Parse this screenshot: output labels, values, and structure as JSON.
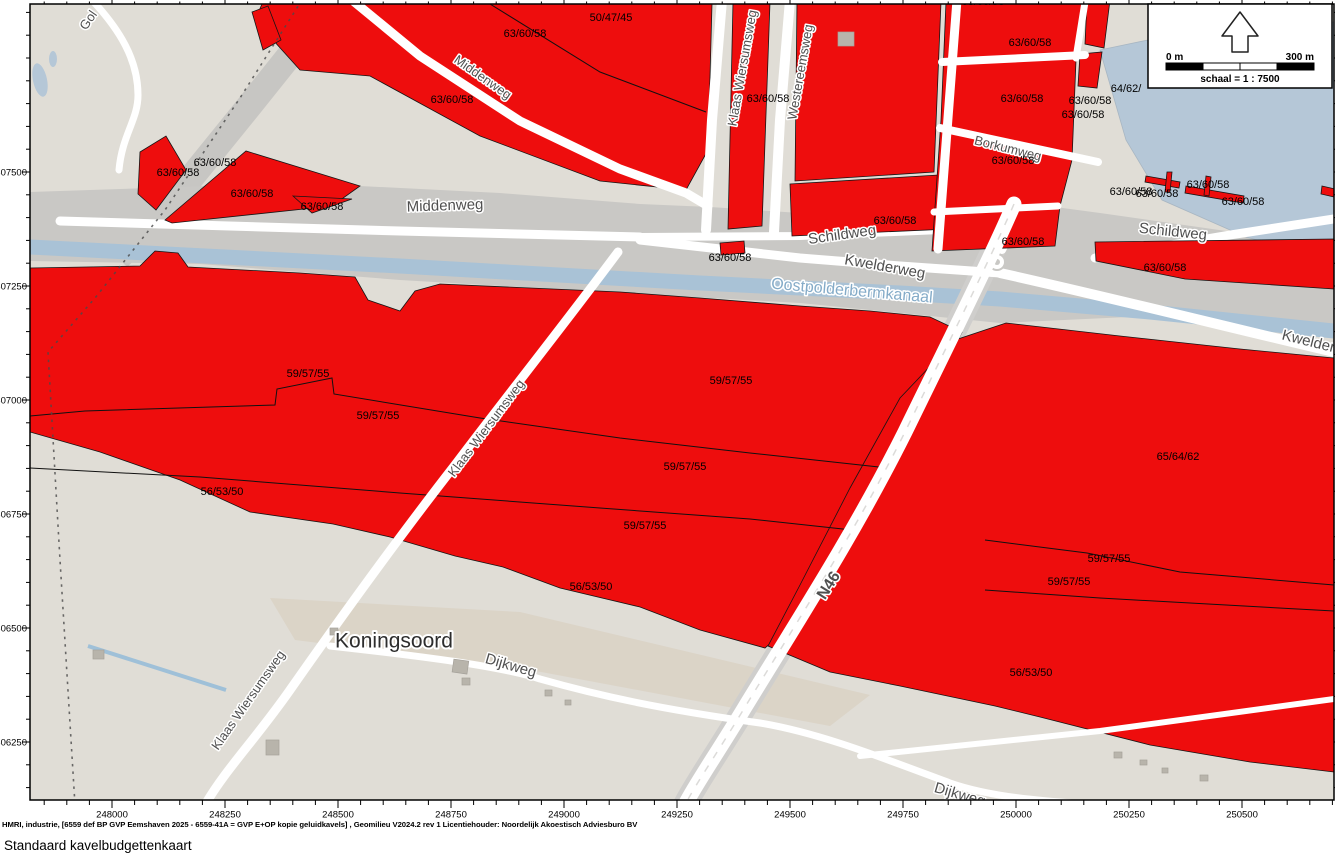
{
  "title": "Standaard kavelbudgettenkaart",
  "credit": "HMRI, industrie, [6559 def BP GVP Eemshaven 2025 - 6559-41A = GVP E+OP kopie geluidkavels] , Geomilieu V2024.2 rev 1 Licentiehouder: Noordelijk Akoestisch Adviesburo BV",
  "scale_box": {
    "left": "0 m",
    "right": "300 m",
    "text": "schaal = 1 : 7500"
  },
  "colors": {
    "zone_red": "#ee0d0d",
    "water": "#b5c7d7",
    "canal": "#a9c2d6",
    "corridor_gray": "#c9c8c5",
    "base_beige": "#e0ddd6",
    "road_white": "#ffffff",
    "road_label": "#4f4f4f",
    "water_label": "#84abc8",
    "green": "#ccd8a6",
    "building": "#b8b4ab"
  },
  "axes": {
    "x": [
      {
        "label": "248000",
        "pos": 112
      },
      {
        "label": "248250",
        "pos": 225
      },
      {
        "label": "248500",
        "pos": 338
      },
      {
        "label": "248750",
        "pos": 451
      },
      {
        "label": "249000",
        "pos": 564
      },
      {
        "label": "249250",
        "pos": 677
      },
      {
        "label": "249500",
        "pos": 790
      },
      {
        "label": "249750",
        "pos": 903
      },
      {
        "label": "250000",
        "pos": 1016
      },
      {
        "label": "250250",
        "pos": 1129
      },
      {
        "label": "250500",
        "pos": 1242
      }
    ],
    "y": [
      {
        "label": "607500",
        "pos": 172
      },
      {
        "label": "607250",
        "pos": 286
      },
      {
        "label": "607000",
        "pos": 400
      },
      {
        "label": "606750",
        "pos": 514
      },
      {
        "label": "606500",
        "pos": 628
      },
      {
        "label": "606250",
        "pos": 742
      }
    ]
  },
  "labels": {
    "values": [
      {
        "t": "50/47/45",
        "x": 611,
        "y": 17
      },
      {
        "t": "63/60/58",
        "x": 525,
        "y": 33
      },
      {
        "t": "63/60/58",
        "x": 452,
        "y": 99
      },
      {
        "t": "63/60/58",
        "x": 768,
        "y": 98
      },
      {
        "t": "63/60/58",
        "x": 983,
        "y": 1
      },
      {
        "t": "63/60/58",
        "x": 1030,
        "y": 42
      },
      {
        "t": "63/60/58",
        "x": 1022,
        "y": 98
      },
      {
        "t": "63/60/58",
        "x": 1090,
        "y": 100
      },
      {
        "t": "63/60/58",
        "x": 1083,
        "y": 114
      },
      {
        "t": "64/62/",
        "x": 1126,
        "y": 88
      },
      {
        "t": "63/60/58",
        "x": 1013,
        "y": 160
      },
      {
        "t": "63/60/58",
        "x": 215,
        "y": 162
      },
      {
        "t": "63/60/58",
        "x": 178,
        "y": 172
      },
      {
        "t": "63/60/58",
        "x": 252,
        "y": 193
      },
      {
        "t": "63/60/58",
        "x": 322,
        "y": 206
      },
      {
        "t": "63/60/58",
        "x": 895,
        "y": 220
      },
      {
        "t": "63/60/58",
        "x": 730,
        "y": 257
      },
      {
        "t": "63/60/58",
        "x": 1023,
        "y": 241
      },
      {
        "t": "63/60/58",
        "x": 1165,
        "y": 267
      },
      {
        "t": "63/60/58",
        "x": 1131,
        "y": 191
      },
      {
        "t": "63/60/58",
        "x": 1157,
        "y": 193
      },
      {
        "t": "63/60/58",
        "x": 1208,
        "y": 184
      },
      {
        "t": "63/60/58",
        "x": 1243,
        "y": 201
      },
      {
        "t": "59/57/55",
        "x": 308,
        "y": 373
      },
      {
        "t": "59/57/55",
        "x": 378,
        "y": 415
      },
      {
        "t": "59/57/55",
        "x": 731,
        "y": 380
      },
      {
        "t": "59/57/55",
        "x": 685,
        "y": 466
      },
      {
        "t": "59/57/55",
        "x": 645,
        "y": 525
      },
      {
        "t": "56/53/50",
        "x": 222,
        "y": 491
      },
      {
        "t": "56/53/50",
        "x": 591,
        "y": 586
      },
      {
        "t": "65/64/62",
        "x": 1178,
        "y": 456
      },
      {
        "t": "59/57/55",
        "x": 1109,
        "y": 558
      },
      {
        "t": "59/57/55",
        "x": 1069,
        "y": 581
      },
      {
        "t": "56/53/50",
        "x": 1031,
        "y": 672
      }
    ],
    "roads": [
      {
        "t": "Gol",
        "x": 88,
        "y": 20,
        "r": -55,
        "s": 13
      },
      {
        "t": "Middenweg",
        "x": 483,
        "y": 77,
        "r": 35,
        "s": 13
      },
      {
        "t": "Middenweg",
        "x": 445,
        "y": 205,
        "r": -2,
        "s": 15
      },
      {
        "t": "Klaas Wiersumsweg",
        "x": 742,
        "y": 68,
        "r": -80,
        "s": 13
      },
      {
        "t": "Westereemsweg",
        "x": 800,
        "y": 72,
        "r": -80,
        "s": 13
      },
      {
        "t": "Borkumweg",
        "x": 1008,
        "y": 148,
        "r": 14,
        "s": 13
      },
      {
        "t": "Schildweg",
        "x": 842,
        "y": 234,
        "r": -8,
        "s": 15
      },
      {
        "t": "Schildweg",
        "x": 1173,
        "y": 231,
        "r": 6,
        "s": 15
      },
      {
        "t": "Kwelderweg",
        "x": 885,
        "y": 266,
        "r": 10,
        "s": 15
      },
      {
        "t": "Kwelderweg",
        "x": 1322,
        "y": 344,
        "r": 14,
        "s": 15
      },
      {
        "t": "Klaas Wiersumsweg",
        "x": 486,
        "y": 428,
        "r": -53,
        "s": 13
      },
      {
        "t": "Klaas Wiersumsweg",
        "x": 248,
        "y": 700,
        "r": -55,
        "s": 13
      },
      {
        "t": "Dijkweg",
        "x": 511,
        "y": 665,
        "r": 16,
        "s": 15
      },
      {
        "t": "Dijkweg",
        "x": 960,
        "y": 794,
        "r": 16,
        "s": 15
      },
      {
        "t": "N46",
        "x": 828,
        "y": 585,
        "r": -58,
        "s": 16,
        "b": 1,
        "c": "#6e6e6e"
      }
    ],
    "places": [
      {
        "t": "Koningsoord",
        "x": 394,
        "y": 640,
        "s": 21
      }
    ],
    "water": [
      {
        "t": "Oostpolderbermkanaal",
        "x": 852,
        "y": 290,
        "r": 5,
        "s": 16
      }
    ]
  }
}
